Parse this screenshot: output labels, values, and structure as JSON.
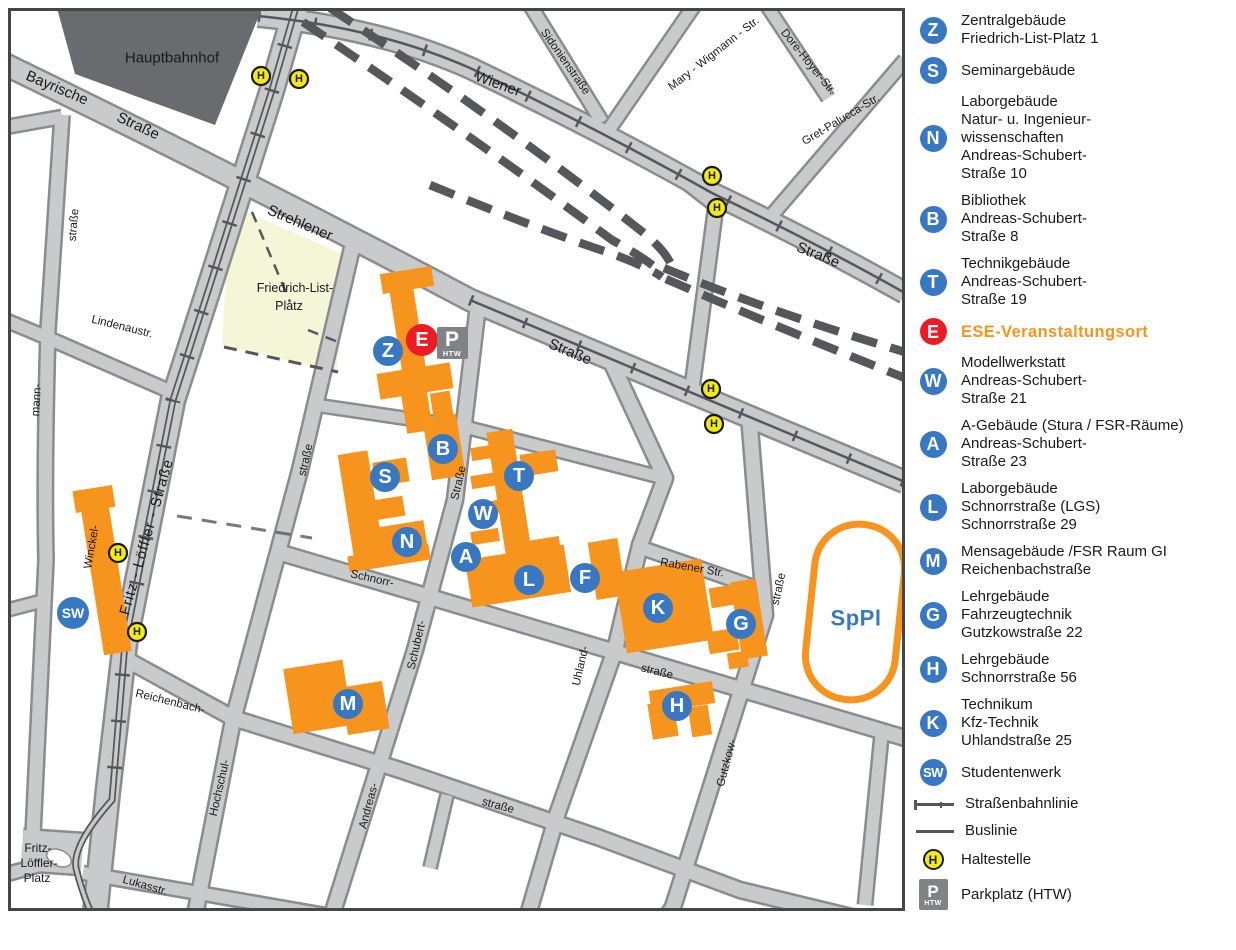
{
  "colors": {
    "building_orange": "#F7941D",
    "marker_blue": "#3878C2",
    "event_red": "#ED1C24",
    "stop_yellow": "#F2EA15",
    "parking_gray": "#818285",
    "rail_dark": "#55575A",
    "sppl_blue": "#3878C2"
  },
  "legend": {
    "items": [
      {
        "icon": "Z",
        "kind": "letter",
        "lines": [
          "Zentralgebäude",
          "Friedrich-List-Platz 1"
        ]
      },
      {
        "icon": "S",
        "kind": "letter",
        "lines": [
          "Seminargebäude"
        ]
      },
      {
        "icon": "N",
        "kind": "letter",
        "lines": [
          "Laborgebäude",
          "Natur- u. Ingenieur-",
          "wissenschaften",
          "Andreas-Schubert-",
          "Straße 10"
        ]
      },
      {
        "icon": "B",
        "kind": "letter",
        "lines": [
          "Bibliothek",
          "Andreas-Schubert-",
          "Straße 8"
        ]
      },
      {
        "icon": "T",
        "kind": "letter",
        "lines": [
          "Technikgebäude",
          "Andreas-Schubert-",
          "Straße 19"
        ]
      },
      {
        "icon": "E",
        "kind": "event",
        "lines": [
          "ESE-Veranstaltungsort"
        ]
      },
      {
        "icon": "W",
        "kind": "letter",
        "lines": [
          "Modellwerkstatt",
          "Andreas-Schubert-",
          "Straße 21"
        ]
      },
      {
        "icon": "A",
        "kind": "letter",
        "lines": [
          "A-Gebäude (Stura / FSR-Räume)",
          "Andreas-Schubert-",
          "Straße 23"
        ]
      },
      {
        "icon": "L",
        "kind": "letter",
        "lines": [
          "Laborgebäude",
          "Schnorrstraße (LGS)",
          "Schnorrstraße 29"
        ]
      },
      {
        "icon": "M",
        "kind": "letter",
        "lines": [
          "Mensagebäude /FSR Raum GI",
          "Reichenbachstraße"
        ]
      },
      {
        "icon": "G",
        "kind": "letter",
        "lines": [
          "Lehrgebäude",
          "Fahrzeugtechnik",
          "Gutzkowstraße 22"
        ]
      },
      {
        "icon": "H",
        "kind": "letter",
        "lines": [
          "Lehrgebäude",
          "Schnorrstraße 56"
        ]
      },
      {
        "icon": "K",
        "kind": "letter",
        "lines": [
          "Technikum",
          "Kfz-Technik",
          "Uhlandstraße 25"
        ]
      },
      {
        "icon": "SW",
        "kind": "sw",
        "lines": [
          "Studentenwerk"
        ]
      },
      {
        "icon": "",
        "kind": "tram",
        "lines": [
          "Straßenbahnlinie"
        ]
      },
      {
        "icon": "",
        "kind": "bus",
        "lines": [
          "Buslinie"
        ]
      },
      {
        "icon": "H",
        "kind": "stop",
        "lines": [
          "Haltestelle"
        ]
      },
      {
        "icon": "P",
        "kind": "parking",
        "lines": [
          "Parkplatz (HTW)"
        ]
      }
    ]
  },
  "map": {
    "labels": [
      {
        "t": "Hauptbahnhof",
        "x": 172,
        "y": 58,
        "r": 0,
        "s": 15
      },
      {
        "t": "Bayrische",
        "x": 57,
        "y": 88,
        "r": 23,
        "s": 15
      },
      {
        "t": "Straße",
        "x": 138,
        "y": 126,
        "r": 25,
        "s": 15
      },
      {
        "t": "Strehlener",
        "x": 300,
        "y": 223,
        "r": 23,
        "s": 15
      },
      {
        "t": "Straße",
        "x": 570,
        "y": 352,
        "r": 23,
        "s": 15
      },
      {
        "t": "Wiener",
        "x": 498,
        "y": 84,
        "r": 20,
        "s": 15
      },
      {
        "t": "Straße",
        "x": 818,
        "y": 255,
        "r": 22,
        "s": 15
      },
      {
        "t": "Sidonienstraße",
        "x": 565,
        "y": 62,
        "r": 55,
        "s": 11.5
      },
      {
        "t": "Mary - Wigmann - Str.",
        "x": 714,
        "y": 54,
        "r": -38,
        "s": 11.5
      },
      {
        "t": "Dore-Hoyer-Str.",
        "x": 808,
        "y": 62,
        "r": 51,
        "s": 11.5
      },
      {
        "t": "Gret-Palucca-Str.",
        "x": 841,
        "y": 120,
        "r": -31,
        "s": 11.5
      },
      {
        "t": "straße",
        "x": 74,
        "y": 225,
        "r": -85,
        "s": 11.5
      },
      {
        "t": "mann-",
        "x": 37,
        "y": 400,
        "r": -86,
        "s": 11.5
      },
      {
        "t": "Winckel-",
        "x": 92,
        "y": 547,
        "r": -80,
        "s": 11.5
      },
      {
        "t": "Lindenaustr.",
        "x": 122,
        "y": 327,
        "r": 14,
        "s": 11.5
      },
      {
        "t": "Fritz - Löffler - Straße",
        "x": 147,
        "y": 537,
        "r": -74,
        "s": 14.5,
        "ls": 1
      },
      {
        "t": "straße",
        "x": 306,
        "y": 460,
        "r": -77,
        "s": 11.5
      },
      {
        "t": "Hochschul-",
        "x": 220,
        "y": 788,
        "r": -77,
        "s": 11.5
      },
      {
        "t": "Straße",
        "x": 459,
        "y": 483,
        "r": -77,
        "s": 11.5
      },
      {
        "t": "Schubert-",
        "x": 417,
        "y": 645,
        "r": -77,
        "s": 11.5
      },
      {
        "t": "Andreas-",
        "x": 369,
        "y": 806,
        "r": -75,
        "s": 11.5
      },
      {
        "t": "Uhland-",
        "x": 581,
        "y": 666,
        "r": -77,
        "s": 11.5
      },
      {
        "t": "straße",
        "x": 779,
        "y": 589,
        "r": -78,
        "s": 11.5
      },
      {
        "t": "Gutzkow-",
        "x": 727,
        "y": 763,
        "r": -75,
        "s": 11.5
      },
      {
        "t": "Schnorr-",
        "x": 372,
        "y": 579,
        "r": 13,
        "s": 11.5
      },
      {
        "t": "straße",
        "x": 657,
        "y": 672,
        "r": 14,
        "s": 11.5
      },
      {
        "t": "Rabener Str.",
        "x": 692,
        "y": 568,
        "r": 10,
        "s": 11.5
      },
      {
        "t": "Reichenbach-",
        "x": 170,
        "y": 702,
        "r": 14,
        "s": 11.5
      },
      {
        "t": "straße",
        "x": 498,
        "y": 806,
        "r": 15,
        "s": 11.5
      },
      {
        "t": "Lukasstr.",
        "x": 145,
        "y": 886,
        "r": 16,
        "s": 11.5
      },
      {
        "t": "Friedrich-List-",
        "x": 295,
        "y": 288,
        "r": 0,
        "s": 12.5
      },
      {
        "t": "Platz",
        "x": 289,
        "y": 306,
        "r": 0,
        "s": 12.5
      },
      {
        "t": "Fritz-",
        "x": 38,
        "y": 848,
        "r": 0,
        "s": 12
      },
      {
        "t": "Löffler-",
        "x": 39,
        "y": 863,
        "r": 0,
        "s": 12
      },
      {
        "t": "Platz",
        "x": 37,
        "y": 878,
        "r": 0,
        "s": 12
      },
      {
        "t": "SpPl",
        "x": 856,
        "y": 618,
        "r": 0,
        "s": 22,
        "c": "#3878C2",
        "w": "bold",
        "ls": 0.5
      }
    ],
    "markers": [
      {
        "id": "Z",
        "x": 388,
        "y": 351
      },
      {
        "id": "S",
        "x": 385,
        "y": 477
      },
      {
        "id": "B",
        "x": 443,
        "y": 449
      },
      {
        "id": "N",
        "x": 407,
        "y": 542
      },
      {
        "id": "T",
        "x": 519,
        "y": 476
      },
      {
        "id": "W",
        "x": 483,
        "y": 514
      },
      {
        "id": "A",
        "x": 466,
        "y": 557
      },
      {
        "id": "L",
        "x": 529,
        "y": 580
      },
      {
        "id": "F",
        "x": 585,
        "y": 578
      },
      {
        "id": "K",
        "x": 658,
        "y": 608
      },
      {
        "id": "G",
        "x": 741,
        "y": 624
      },
      {
        "id": "H",
        "x": 677,
        "y": 706
      },
      {
        "id": "M",
        "x": 348,
        "y": 704
      },
      {
        "id": "SW",
        "x": 73,
        "y": 613,
        "kind": "sw"
      },
      {
        "id": "E",
        "x": 422,
        "y": 340,
        "kind": "event"
      },
      {
        "id": "P",
        "x": 452,
        "y": 343,
        "kind": "parking",
        "sub": "HTW"
      }
    ],
    "stops": [
      [
        261,
        76
      ],
      [
        299,
        79
      ],
      [
        712,
        176
      ],
      [
        717,
        208
      ],
      [
        711,
        389
      ],
      [
        714,
        424
      ],
      [
        118,
        553
      ],
      [
        137,
        632
      ]
    ]
  }
}
